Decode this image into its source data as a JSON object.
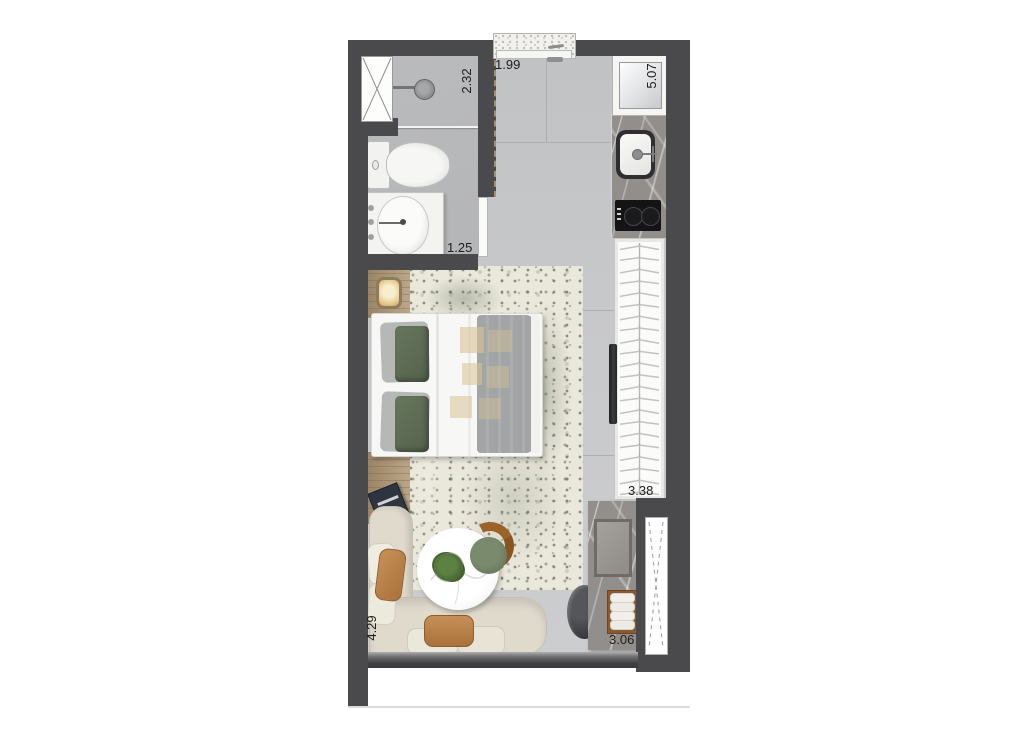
{
  "plan": {
    "type": "studio apartment floor plan",
    "dimensions": {
      "shower_wall": "2.32",
      "entry_wall": "1.99",
      "kitchen_wall": "5.07",
      "bath_interior": "1.25",
      "closet_wall": "3.38",
      "living_wall": "4.29",
      "bottom_wall": "3.06"
    },
    "closet": {
      "hanger_count": 22
    },
    "colors": {
      "wall": "#4a4a4c",
      "floor": "#c6c7c9",
      "bath_floor": "#b9babc",
      "rug": "#eae7db",
      "sofa": "#e0dacd",
      "wood": "#b29a79",
      "marble": "#918e8b",
      "pillow_green": "#5d6b54",
      "accent_tan": "#bc8851",
      "label": "#1c1c1c"
    }
  }
}
